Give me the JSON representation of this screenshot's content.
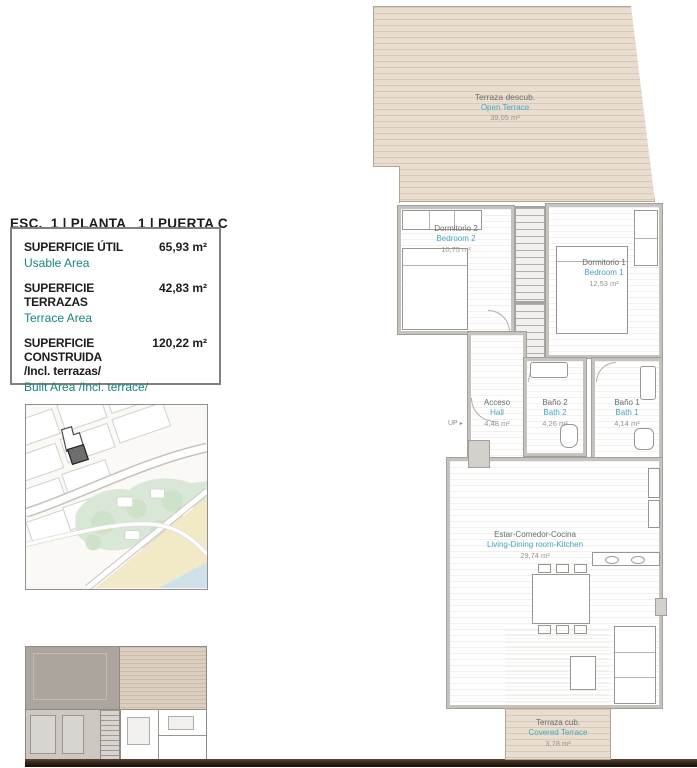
{
  "colors": {
    "accent_teal": "#15867e",
    "plan_label_blue": "#45a6c2",
    "terrace_tan": "#e9ddd0",
    "wall_gray": "#c6c3bf",
    "map_green": "#d9e8d6",
    "map_sand": "#f2e9c6",
    "map_water": "#cfe0e8",
    "baseline_dark": "#2e2013"
  },
  "header": {
    "title_es": "ESC.  1 | PLANTA   1 | PUERTA C",
    "title_en": "Staircase.  1 | Floor   1 | Door C"
  },
  "summary": {
    "usable_label_es": "SUPERFICIE ÚTIL",
    "usable_label_en": "Usable Area",
    "usable_value": "65,93 m²",
    "terrace_label_es": "SUPERFICIE TERRAZAS",
    "terrace_label_en": "Terrace Area",
    "terrace_value": "42,83 m²",
    "built_label_es": "SUPERFICIE CONSTRUIDA",
    "built_label_es_2": "/Incl. terrazas/",
    "built_label_en": "Built Area /Incl. terrace/",
    "built_value": "120,22 m²"
  },
  "plan": {
    "up_label": "UP",
    "rooms": [
      {
        "id": "open-terrace",
        "name_es": "Terraza descub.",
        "name_en": "Open Terrace",
        "area": "39,05 m²"
      },
      {
        "id": "bedroom-2",
        "name_es": "Dormitorio 2",
        "name_en": "Bedroom 2",
        "area": "10,75 m²"
      },
      {
        "id": "bedroom-1",
        "name_es": "Dormitorio 1",
        "name_en": "Bedroom 1",
        "area": "12,53 m²"
      },
      {
        "id": "hall",
        "name_es": "Acceso",
        "name_en": "Hall",
        "area": "4,48 m²"
      },
      {
        "id": "bath-2",
        "name_es": "Baño 2",
        "name_en": "Bath 2",
        "area": "4,26 m²"
      },
      {
        "id": "bath-1",
        "name_es": "Baño 1",
        "name_en": "Bath 1",
        "area": "4,14 m²"
      },
      {
        "id": "living",
        "name_es": "Estar-Comedor-Cocina",
        "name_en": "Living-Dining room-Kitchen",
        "area": "29,74 m²"
      },
      {
        "id": "covered-terrace",
        "name_es": "Terraza cub.",
        "name_en": "Covered Terrace",
        "area": "3,78 m²"
      }
    ]
  }
}
